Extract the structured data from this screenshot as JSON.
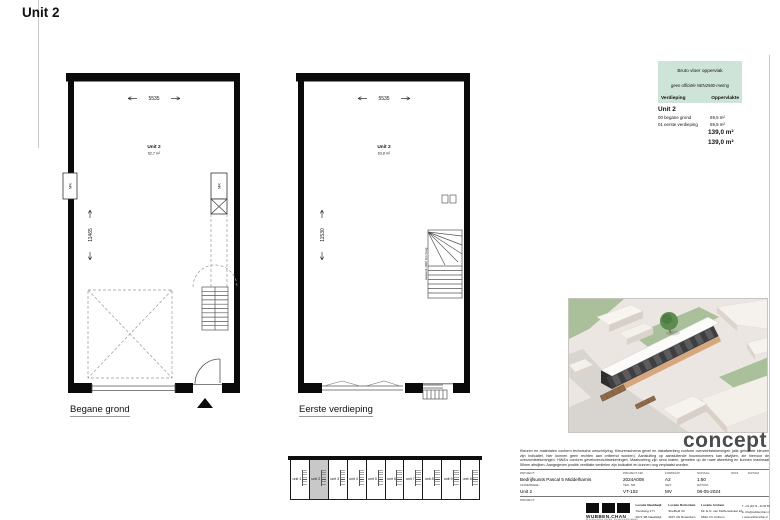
{
  "page_title": "Unit 2",
  "colors": {
    "table_header_green": "#cfe4d9",
    "keyplan_highlight": "#c8c8c8",
    "concept_gray": "#4c4c4c",
    "wall_black": "#0a0a0a",
    "building_dark": "#3f3e40",
    "grass_green": "#a9c09a",
    "sand_path": "#d7a77c"
  },
  "plans": {
    "ground": {
      "unit_label": "Unit 2",
      "area": "62,7 m²",
      "width_dim": "5535",
      "height_dim": "11465",
      "mk_left": "MK",
      "mk_right": "MK",
      "caption": "Begane grond"
    },
    "first": {
      "unit_label": "Unit 2",
      "area": "63,8 m²",
      "width_dim": "5535",
      "height_dim": "11530",
      "stair_note": "Hekwerk 1000 mm hoog",
      "caption": "Eerste verdieping"
    }
  },
  "area_table": {
    "title": "Bruto vloer oppervlak",
    "subtitle": "geen officiële NEN2580-meting",
    "col_floor": "Verdieping",
    "col_area": "Oppervlakte",
    "group_label": "Unit 2",
    "rows": [
      {
        "floor": "00 begane grond",
        "area": "69,5 m²"
      },
      {
        "floor": "01 eerste verdieping",
        "area": "69,5 m²"
      }
    ],
    "total_1": "139,0 m²",
    "total_2": "139,0 m²"
  },
  "render": {
    "caption": "concept"
  },
  "keyplan": {
    "units": [
      "unit 1",
      "unit 2",
      "unit 3",
      "unit 4",
      "unit 5",
      "unit 6",
      "unit 7",
      "unit 8",
      "unit 9",
      "unit 10"
    ],
    "highlighted": "unit 2"
  },
  "titleblock": {
    "disclaimer": "Kleuren en materialen conform technische omschrijving. Kleurenschema gevel en dakafwerking conform overzichtstekeningen (alle getoonde kleuren zijn indicatief, hier kunnen geen rechten aan ontleend worden). Aansluiting op aansluitende bouwnummers kan afwijken, zie hiervoor de overzichtstekeningen. HWA's conform geveloverzichtstekeningen. Maatvoering zijn circa maten, gemeten op de ruwe afwerking en kunnen maximaal 50mm afwijken. Aangegeven positie ventilatie ventielen zijn indicatief en kunnen nog verplaatst worden.",
    "project_label": "PROJECT:",
    "project_value": "Bedrijfsunits Pascal 5 Middelharnis",
    "project_nr_label": "PROJECT NR.",
    "project_nr_value": "2024A008",
    "formaat_label": "FORMAAT:",
    "formaat_value": "A2",
    "schaal_label": "SCHAAL:",
    "schaal_value": "1:50",
    "wijz_label": "WIJZ",
    "datum_col_label": "DATUM",
    "onderdeel_label": "ONDERDEEL:",
    "onderdeel_value": "Unit 2",
    "tek_nr_label": "TEK. NR.",
    "tek_nr_value": "VT-102",
    "get_label": "GET.",
    "get_value": "MV",
    "datum_label": "DATUM:",
    "datum_value": "08-05-2024",
    "project2_label": "PROJECT:",
    "brand": {
      "logo": "WUBBEN.CHAN",
      "tagline": "BOUWKUNDIG TEKEN- EN ADVIESBUREAU"
    },
    "locations": [
      {
        "title": "Locatie Naaldwijk",
        "line1": "Tiendweg 2 H",
        "line2": "2671 SB Naaldwijk"
      },
      {
        "title": "Locatie Rotterdam",
        "line1": "Sheffield 33",
        "line2": "3047 AN Rotterdam"
      },
      {
        "title": "Locatie Arnhem",
        "line1": "Mr. E.N. van Kleffensstraat 10",
        "line2": "6842 CV Arnhem"
      }
    ],
    "contact": {
      "line1": "T. +31 (0)174 - 40 90 55",
      "line2": "E. info@wubbenchan.nl",
      "line3": "I. www.wubbenchan.nl"
    }
  }
}
